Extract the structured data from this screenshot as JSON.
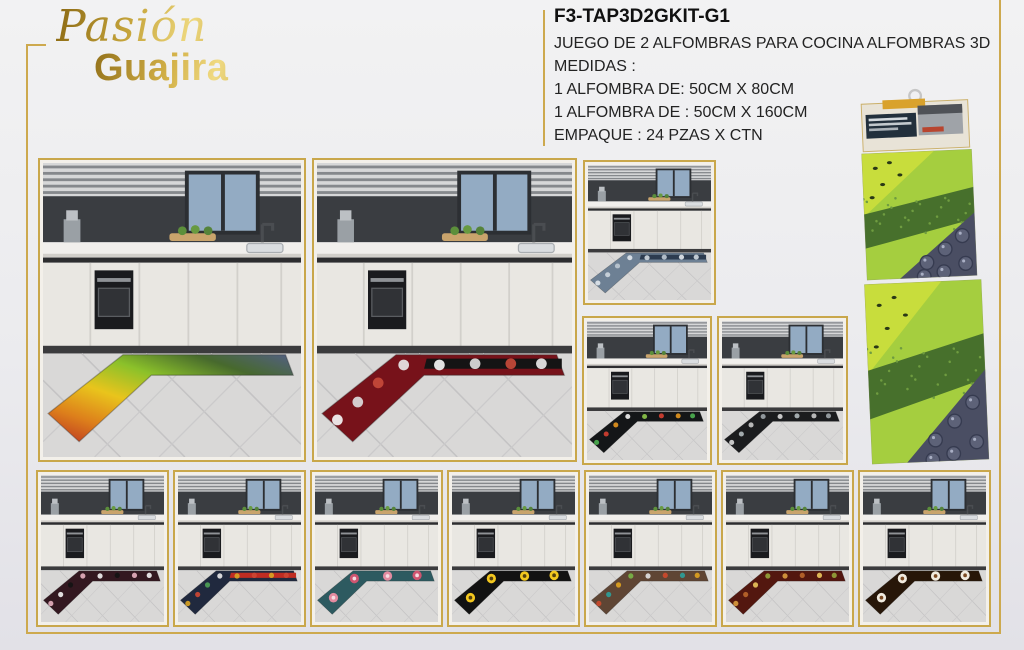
{
  "brand": {
    "word1": "Pasión",
    "word2": "Guajira",
    "gold_dark": "#8a6812",
    "gold_light": "#eed87e"
  },
  "product_info": {
    "sku": "F3-TAP3D2GKIT-G1",
    "lines": [
      "JUEGO DE 2 ALFOMBRAS PARA COCINA ALFOMBRAS 3D",
      "MEDIDAS :",
      "1 ALFOMBRA DE: 50CM X 80CM",
      "1 ALFOMBRA DE : 50CM X 160CM",
      "EMPAQUE : 24 PZAS X CTN"
    ]
  },
  "frame_color": "#cda94e",
  "gallery": {
    "photos": [
      {
        "name": "kitchen-photo-fruit-rainbow-mat",
        "x": 38,
        "y": 158,
        "w": 268,
        "h": 304,
        "mat": {
          "stops": [
            "#b92f23",
            "#dd7f1b",
            "#e9c41c",
            "#8bc12a",
            "#47692d",
            "#535f84"
          ]
        }
      },
      {
        "name": "kitchen-photo-chef-red-mat",
        "x": 312,
        "y": 158,
        "w": 265,
        "h": 304,
        "mat": {
          "base": "#77121a",
          "band": "#141414",
          "accents": [
            "#f4f4f4",
            "#dcdcdc",
            "#c74a3a",
            "#e8e8e8"
          ]
        }
      },
      {
        "name": "kitchen-photo-denim-blue-mat",
        "x": 583,
        "y": 160,
        "w": 133,
        "h": 145,
        "mat": {
          "base": "#6d8094",
          "band": "#2d3c50",
          "accents": [
            "#dfe5ea",
            "#cdd6dd",
            "#bcc7d0"
          ]
        }
      },
      {
        "name": "kitchen-photo-black-veggie-doodle-mat",
        "x": 582,
        "y": 316,
        "w": 130,
        "h": 149,
        "mat": {
          "base": "#141618",
          "accents": [
            "#4caf50",
            "#d23f31",
            "#e0921e",
            "#ececec",
            "#8bc34a",
            "#d23f31",
            "#e0921e",
            "#4caf50"
          ]
        }
      },
      {
        "name": "kitchen-photo-chalkboard-doodle-mat",
        "x": 717,
        "y": 316,
        "w": 131,
        "h": 149,
        "mat": {
          "base": "#1b1c1e",
          "accents": [
            "#d5d5d5",
            "#aeb6ba",
            "#c4c4c4",
            "#9aa2a6"
          ]
        }
      },
      {
        "name": "kitchen-photo-checker-coffee-maroon-mat",
        "x": 36,
        "y": 470,
        "w": 133,
        "h": 157,
        "mat": {
          "base": "#331820",
          "accents": [
            "#e3aebc",
            "#efefef",
            "#141414",
            "#e3aebc",
            "#efefef",
            "#141414",
            "#e3aebc",
            "#efefef"
          ]
        }
      },
      {
        "name": "kitchen-photo-navy-food-mat",
        "x": 173,
        "y": 470,
        "w": 133,
        "h": 157,
        "mat": {
          "base": "#20293e",
          "band": "#bf2c22",
          "accents": [
            "#d8a324",
            "#cc4633",
            "#4d9e55",
            "#e6e6e6",
            "#d8a324",
            "#cc4633"
          ]
        }
      },
      {
        "name": "kitchen-photo-teal-peony-mat",
        "x": 310,
        "y": 470,
        "w": 133,
        "h": 157,
        "mat": {
          "base": "#2d5a60",
          "big": true,
          "center": "#f6dce2",
          "accents": [
            "#e28ba0",
            "#cf5570",
            "#e28ba0",
            "#cf5570"
          ]
        }
      },
      {
        "name": "kitchen-photo-black-sunflower-mat",
        "x": 447,
        "y": 470,
        "w": 133,
        "h": 157,
        "mat": {
          "base": "#121212",
          "big": true,
          "center": "#55400e",
          "accents": [
            "#f3c71e"
          ]
        }
      },
      {
        "name": "kitchen-photo-wood-mugs-mat",
        "x": 584,
        "y": 470,
        "w": 133,
        "h": 157,
        "mat": {
          "base": "#5f4534",
          "accents": [
            "#cc4a2d",
            "#2e9e98",
            "#dda11f",
            "#79b347",
            "#e0e0e0",
            "#cc4a2d",
            "#2e9e98",
            "#dda11f"
          ]
        }
      },
      {
        "name": "kitchen-photo-spice-bottles-red-mat",
        "x": 721,
        "y": 470,
        "w": 133,
        "h": 157,
        "mat": {
          "base": "#53170f",
          "accents": [
            "#d89a3e",
            "#b8652a",
            "#e8c25a",
            "#94a23a",
            "#d89a3e",
            "#b8652a",
            "#e8c25a",
            "#94a23a"
          ]
        }
      },
      {
        "name": "kitchen-photo-coffee-cup-brown-mat",
        "x": 858,
        "y": 470,
        "w": 133,
        "h": 157,
        "mat": {
          "base": "#271608",
          "big": true,
          "center": "#7c4a22",
          "accents": [
            "#f1ebdf"
          ]
        }
      }
    ]
  },
  "package": {
    "name": "package-photo-hanging-display",
    "colors": {
      "card": "#e8e3d7",
      "tag": "#d9a22c",
      "label": "#22303c",
      "hook": "#c6c6c6",
      "kiwi": "#c8dd3c",
      "seed": "#2a3816",
      "lettuce": "#a5ce3f",
      "broccoli": "#47702c",
      "broccoliDot": "#6f9c40",
      "berryBg": "#4a4e63",
      "berry": "#5d6278",
      "berryDark": "#363b50",
      "berryShine": "#a9afc4"
    }
  },
  "kitchen_scene_colors": {
    "floor": "#d9d8d7",
    "cabinet": "#e9e7e2",
    "backsplash": "#3a3d41",
    "window": "#93abc3",
    "oven": "#1a1b1e",
    "counter": "#f1efec"
  }
}
